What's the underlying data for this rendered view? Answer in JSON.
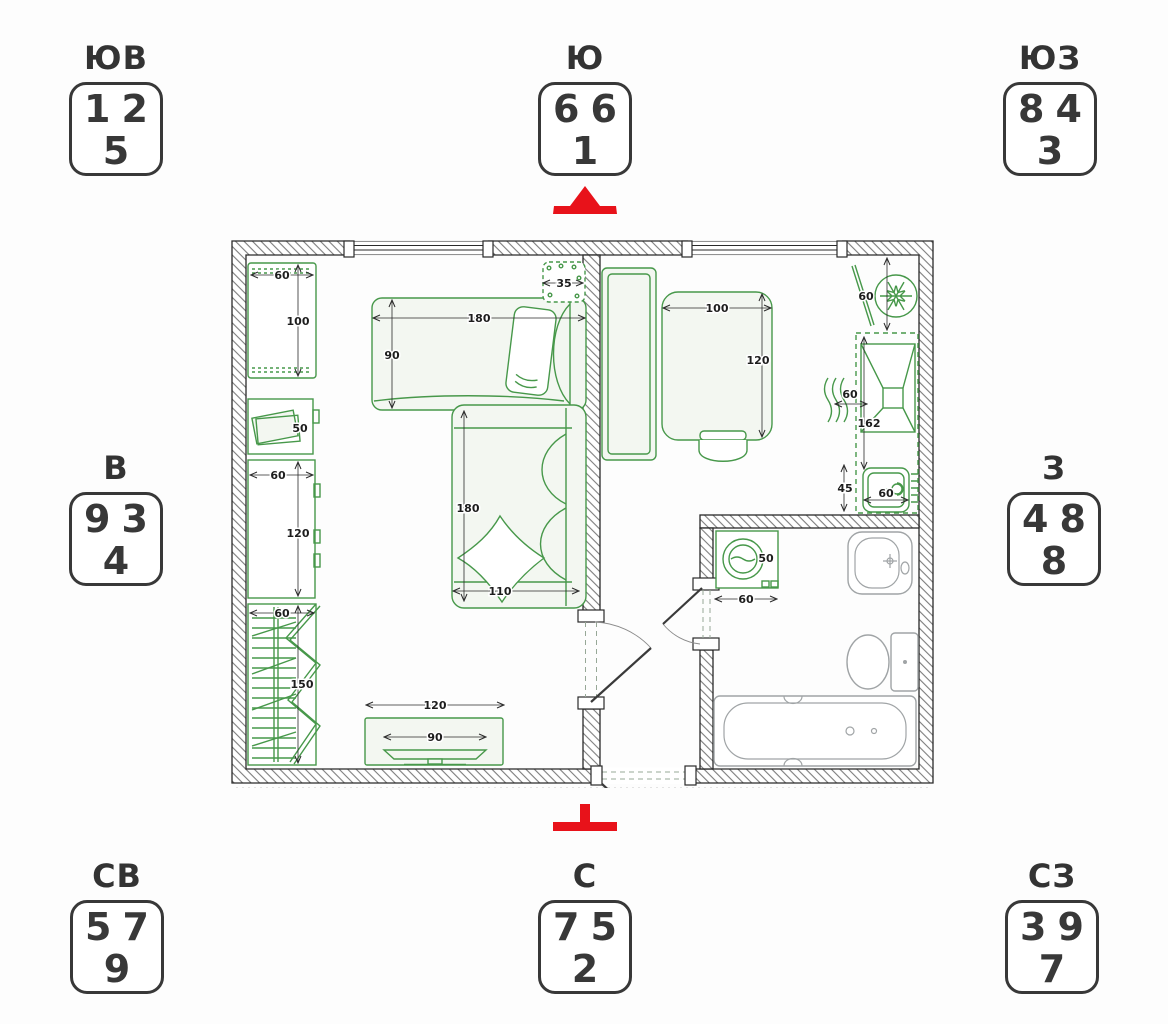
{
  "title": "Apartment floor plan with compass-direction number dice",
  "colors": {
    "background": "#fdfdfd",
    "box_border": "#383838",
    "digit_text": "#383838",
    "entrance_red": "#e8121a",
    "furniture_green": "#47984a",
    "wall_outline": "#2a2a2a",
    "fixture_gray": "#a0a4a6"
  },
  "icons": {
    "south_marker": "red-arrow-up-icon",
    "north_marker": "red-tee-icon",
    "fridge": "snowflake-icon"
  },
  "compass": [
    {
      "direction": "ЮВ",
      "digits": [
        "1",
        "2",
        "5"
      ]
    },
    {
      "direction": "Ю",
      "digits": [
        "6",
        "6",
        "1"
      ],
      "marker": "red-arrow-up"
    },
    {
      "direction": "ЮЗ",
      "digits": [
        "8",
        "4",
        "3"
      ]
    },
    {
      "direction": "В",
      "digits": [
        "9",
        "3",
        "4"
      ]
    },
    {
      "direction": "З",
      "digits": [
        "4",
        "8",
        "8"
      ]
    },
    {
      "direction": "СВ",
      "digits": [
        "5",
        "7",
        "9"
      ]
    },
    {
      "direction": "С",
      "digits": [
        "7",
        "5",
        "2"
      ],
      "marker": "red-tee"
    },
    {
      "direction": "СЗ",
      "digits": [
        "3",
        "9",
        "7"
      ]
    }
  ],
  "floorplan": {
    "dims": {
      "desk_w": "60",
      "desk_l": "100",
      "side_table": "50",
      "cabinet_w": "60",
      "cabinet_l": "120",
      "wardrobe_w": "60",
      "wardrobe_l": "150",
      "tv_stand_w": "120",
      "tv_w": "90",
      "bed_l": "180",
      "bed_w": "90",
      "shelf_w": "35",
      "sofa_l": "180",
      "sofa_w": "110",
      "table_l": "100",
      "table_w": "120",
      "fridge_w": "60",
      "stove_w": "60",
      "counter_l": "162",
      "sink_d": "45",
      "sink_w": "60",
      "washer_w": "50",
      "washer_gap": "60"
    }
  }
}
